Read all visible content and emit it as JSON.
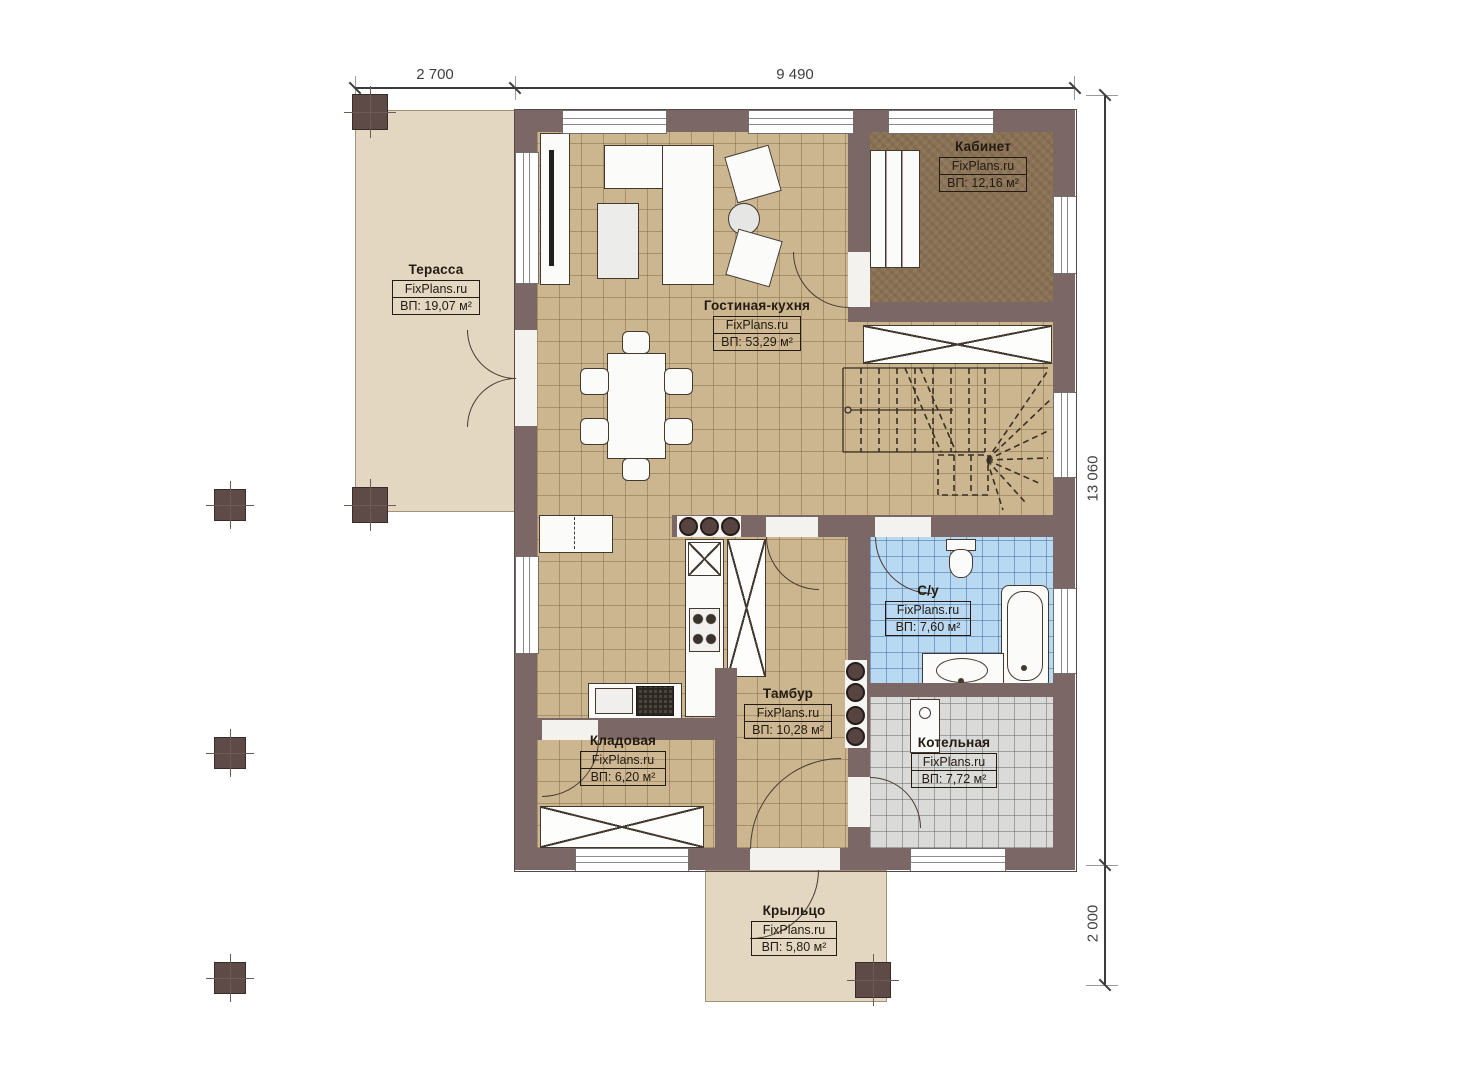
{
  "dimensions": {
    "top_left": "2 700",
    "top_span": "9 490",
    "right_span": "13 060",
    "right_bottom": "2 000"
  },
  "rooms": [
    {
      "name": "Терасса",
      "brand": "FixPlans.ru",
      "area": "ВП: 19,07 м²"
    },
    {
      "name": "Гостиная-кухня",
      "brand": "FixPlans.ru",
      "area": "ВП: 53,29 м²"
    },
    {
      "name": "Кабинет",
      "brand": "FixPlans.ru",
      "area": "ВП: 12,16 м²"
    },
    {
      "name": "С/у",
      "brand": "FixPlans.ru",
      "area": "ВП: 7,60 м²"
    },
    {
      "name": "Тамбур",
      "brand": "FixPlans.ru",
      "area": "ВП: 10,28 м²"
    },
    {
      "name": "Кладовая",
      "brand": "FixPlans.ru",
      "area": "ВП: 6,20 м²"
    },
    {
      "name": "Котельная",
      "brand": "FixPlans.ru",
      "area": "ВП: 7,72 м²"
    },
    {
      "name": "Крыльцо",
      "brand": "FixPlans.ru",
      "area": "ВП: 5,80 м²"
    }
  ],
  "colors": {
    "wall": "#7b6766",
    "tile_beige": "#ccb690",
    "office_floor": "#8b7254",
    "bath_tile": "#b9d8f1",
    "boiler_tile": "#dadad8",
    "terrace": "#e4d7c1"
  }
}
